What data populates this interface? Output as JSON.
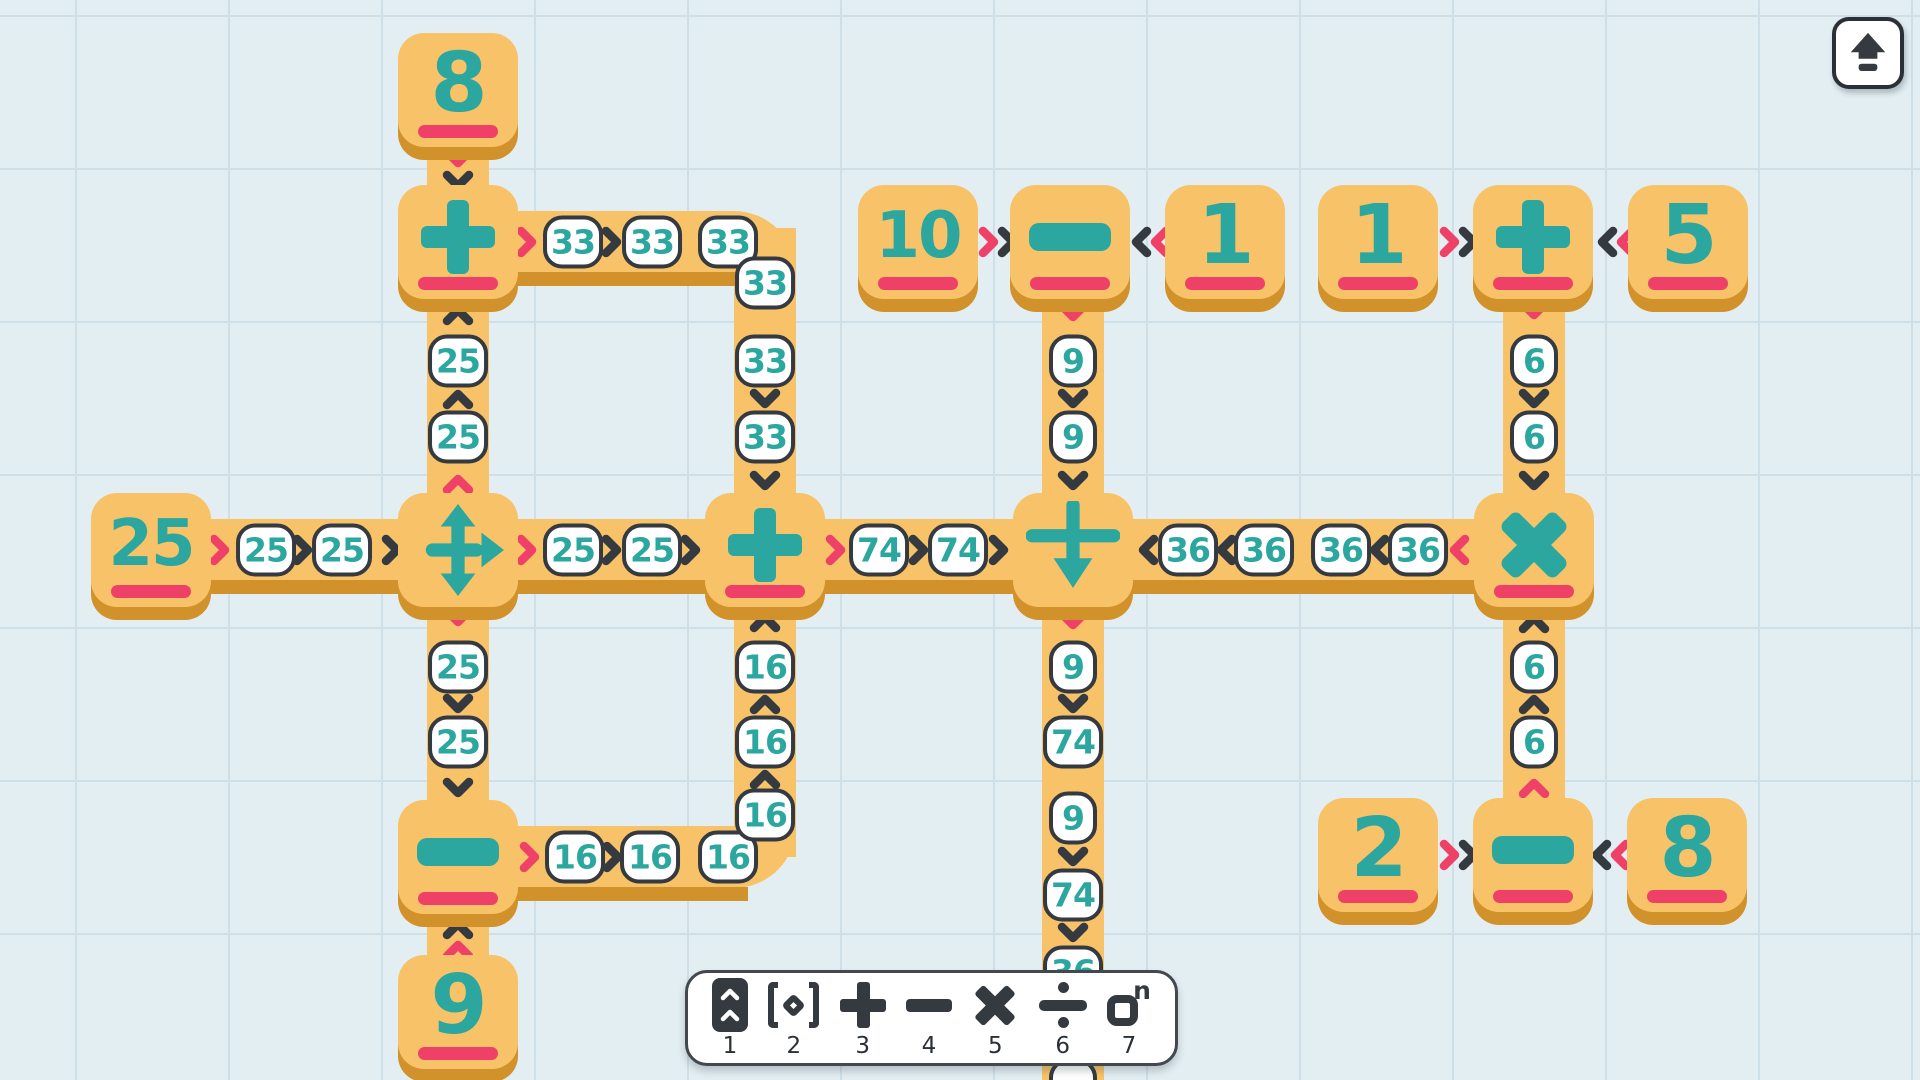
{
  "colors": {
    "background": "#e3eef2",
    "grid_line": "#cfdfe7",
    "tile_orange": "#f8c368",
    "tile_shadow_orange": "#d2922b",
    "teal": "#2ba7a0",
    "pink": "#ef4168",
    "dark": "#343a40",
    "bubble_bg": "#ffffff"
  },
  "board": {
    "paths": [
      {
        "x": 427,
        "y": 100,
        "w": 62,
        "h": 912
      },
      {
        "x": 734,
        "y": 228,
        "w": 62,
        "h": 322
      },
      {
        "x": 458,
        "y": 211,
        "w": 338,
        "h": 62,
        "br": "0 62px 0 0"
      },
      {
        "x": 734,
        "y": 550,
        "w": 62,
        "h": 307
      },
      {
        "x": 458,
        "y": 826,
        "w": 338,
        "h": 62,
        "br": "0 0 62px 0"
      },
      {
        "x": 151,
        "y": 519,
        "w": 1383,
        "h": 62
      },
      {
        "x": 1042,
        "y": 280,
        "w": 62,
        "h": 800
      },
      {
        "x": 1503,
        "y": 280,
        "w": 62,
        "h": 540
      },
      {
        "x": 151,
        "y": 580,
        "w": 1383,
        "h": 14,
        "sh": true
      },
      {
        "x": 482,
        "y": 272,
        "w": 266,
        "h": 14,
        "sh": true
      },
      {
        "x": 482,
        "y": 887,
        "w": 266,
        "h": 14,
        "sh": true
      }
    ],
    "tiles": [
      {
        "id": "tile-number-8-top",
        "kind": "number",
        "label": "8",
        "x": 458,
        "y": 90
      },
      {
        "id": "tile-operator-plus-left",
        "kind": "plus",
        "symbol": "+",
        "x": 458,
        "y": 242
      },
      {
        "id": "tile-number-25-source",
        "kind": "number",
        "label": "25",
        "x": 151,
        "y": 550
      },
      {
        "id": "tile-splitter",
        "kind": "splitter",
        "x": 458,
        "y": 550
      },
      {
        "id": "tile-operator-plus-center",
        "kind": "plus",
        "symbol": "+",
        "x": 765,
        "y": 550
      },
      {
        "id": "tile-junction-merge-down",
        "kind": "junction",
        "x": 1073,
        "y": 550
      },
      {
        "id": "tile-operator-times",
        "kind": "times",
        "symbol": "×",
        "x": 1534,
        "y": 550
      },
      {
        "id": "tile-operator-minus-bottomleft",
        "kind": "minus",
        "symbol": "−",
        "x": 458,
        "y": 857
      },
      {
        "id": "tile-number-9-bottom",
        "kind": "number",
        "label": "9",
        "x": 458,
        "y": 1012
      },
      {
        "id": "tile-number-10",
        "kind": "number",
        "label": "10",
        "x": 918,
        "y": 242
      },
      {
        "id": "tile-operator-minus-top",
        "kind": "minus",
        "symbol": "−",
        "x": 1070,
        "y": 242
      },
      {
        "id": "tile-number-1-left",
        "kind": "number",
        "label": "1",
        "x": 1225,
        "y": 242
      },
      {
        "id": "tile-number-1-right",
        "kind": "number",
        "label": "1",
        "x": 1378,
        "y": 242
      },
      {
        "id": "tile-operator-plus-right",
        "kind": "plus",
        "symbol": "+",
        "x": 1533,
        "y": 242
      },
      {
        "id": "tile-number-5",
        "kind": "number",
        "label": "5",
        "x": 1688,
        "y": 242
      },
      {
        "id": "tile-number-2",
        "kind": "number",
        "label": "2",
        "x": 1378,
        "y": 855
      },
      {
        "id": "tile-operator-minus-bottomright",
        "kind": "minus",
        "symbol": "−",
        "x": 1533,
        "y": 855
      },
      {
        "id": "tile-number-8-bottom",
        "kind": "number",
        "label": "8",
        "x": 1687,
        "y": 855
      }
    ],
    "bubbles": [
      {
        "v": "25",
        "x": 266,
        "y": 550
      },
      {
        "v": "25",
        "x": 342,
        "y": 550
      },
      {
        "v": "25",
        "x": 573,
        "y": 550
      },
      {
        "v": "25",
        "x": 652,
        "y": 550
      },
      {
        "v": "74",
        "x": 879,
        "y": 550
      },
      {
        "v": "74",
        "x": 958,
        "y": 550
      },
      {
        "v": "36",
        "x": 1188,
        "y": 550
      },
      {
        "v": "36",
        "x": 1264,
        "y": 550
      },
      {
        "v": "36",
        "x": 1341,
        "y": 550
      },
      {
        "v": "36",
        "x": 1418,
        "y": 550
      },
      {
        "v": "33",
        "x": 573,
        "y": 242
      },
      {
        "v": "33",
        "x": 652,
        "y": 242
      },
      {
        "v": "33",
        "x": 728,
        "y": 242
      },
      {
        "v": "33",
        "x": 765,
        "y": 283
      },
      {
        "v": "33",
        "x": 765,
        "y": 361
      },
      {
        "v": "33",
        "x": 765,
        "y": 437
      },
      {
        "v": "25",
        "x": 458,
        "y": 361
      },
      {
        "v": "25",
        "x": 458,
        "y": 437
      },
      {
        "v": "25",
        "x": 458,
        "y": 667
      },
      {
        "v": "25",
        "x": 458,
        "y": 742
      },
      {
        "v": "16",
        "x": 575,
        "y": 857
      },
      {
        "v": "16",
        "x": 650,
        "y": 857
      },
      {
        "v": "16",
        "x": 728,
        "y": 857
      },
      {
        "v": "16",
        "x": 765,
        "y": 815
      },
      {
        "v": "16",
        "x": 765,
        "y": 742
      },
      {
        "v": "16",
        "x": 765,
        "y": 667
      },
      {
        "v": "9",
        "x": 1073,
        "y": 361
      },
      {
        "v": "9",
        "x": 1073,
        "y": 437
      },
      {
        "v": "9",
        "x": 1073,
        "y": 667
      },
      {
        "v": "74",
        "x": 1073,
        "y": 742
      },
      {
        "v": "9",
        "x": 1073,
        "y": 818
      },
      {
        "v": "74",
        "x": 1073,
        "y": 895
      },
      {
        "v": "36",
        "x": 1073,
        "y": 972
      },
      {
        "v": "",
        "x": 1073,
        "y": 1085
      },
      {
        "v": "6",
        "x": 1534,
        "y": 361
      },
      {
        "v": "6",
        "x": 1534,
        "y": 437
      },
      {
        "v": "6",
        "x": 1534,
        "y": 667
      },
      {
        "v": "6",
        "x": 1534,
        "y": 742
      }
    ],
    "chevrons": [
      {
        "d": "d",
        "c": "pink",
        "x": 458,
        "y": 158
      },
      {
        "d": "d",
        "c": "dark",
        "x": 458,
        "y": 181
      },
      {
        "d": "u",
        "c": "dark",
        "x": 458,
        "y": 315
      },
      {
        "d": "u",
        "c": "dark",
        "x": 458,
        "y": 399
      },
      {
        "d": "u",
        "c": "pink",
        "x": 458,
        "y": 484
      },
      {
        "d": "d",
        "c": "pink",
        "x": 458,
        "y": 617
      },
      {
        "d": "d",
        "c": "dark",
        "x": 458,
        "y": 704
      },
      {
        "d": "d",
        "c": "dark",
        "x": 458,
        "y": 788
      },
      {
        "d": "u",
        "c": "dark",
        "x": 458,
        "y": 929
      },
      {
        "d": "u",
        "c": "pink",
        "x": 458,
        "y": 950
      },
      {
        "d": "r",
        "c": "pink",
        "x": 527,
        "y": 242
      },
      {
        "d": "r",
        "c": "dark",
        "x": 612,
        "y": 242
      },
      {
        "d": "d",
        "c": "dark",
        "x": 765,
        "y": 399
      },
      {
        "d": "d",
        "c": "dark",
        "x": 765,
        "y": 481
      },
      {
        "d": "r",
        "c": "pink",
        "x": 220,
        "y": 550
      },
      {
        "d": "r",
        "c": "dark",
        "x": 303,
        "y": 550
      },
      {
        "d": "r",
        "c": "dark",
        "x": 392,
        "y": 550
      },
      {
        "d": "r",
        "c": "pink",
        "x": 527,
        "y": 550
      },
      {
        "d": "r",
        "c": "dark",
        "x": 612,
        "y": 550
      },
      {
        "d": "r",
        "c": "dark",
        "x": 691,
        "y": 550
      },
      {
        "d": "r",
        "c": "pink",
        "x": 836,
        "y": 550
      },
      {
        "d": "r",
        "c": "dark",
        "x": 919,
        "y": 550
      },
      {
        "d": "r",
        "c": "dark",
        "x": 999,
        "y": 550
      },
      {
        "d": "l",
        "c": "dark",
        "x": 1148,
        "y": 550
      },
      {
        "d": "l",
        "c": "dark",
        "x": 1226,
        "y": 550
      },
      {
        "d": "l",
        "c": "dark",
        "x": 1379,
        "y": 550
      },
      {
        "d": "l",
        "c": "pink",
        "x": 1459,
        "y": 550
      },
      {
        "d": "r",
        "c": "pink",
        "x": 530,
        "y": 857
      },
      {
        "d": "r",
        "c": "dark",
        "x": 613,
        "y": 857
      },
      {
        "d": "u",
        "c": "dark",
        "x": 765,
        "y": 779
      },
      {
        "d": "u",
        "c": "dark",
        "x": 765,
        "y": 704
      },
      {
        "d": "u",
        "c": "dark",
        "x": 765,
        "y": 622
      },
      {
        "d": "r",
        "c": "pink",
        "x": 989,
        "y": 242
      },
      {
        "d": "r",
        "c": "dark",
        "x": 1008,
        "y": 242
      },
      {
        "d": "l",
        "c": "dark",
        "x": 1141,
        "y": 242
      },
      {
        "d": "l",
        "c": "pink",
        "x": 1160,
        "y": 242
      },
      {
        "d": "d",
        "c": "pink",
        "x": 1073,
        "y": 312
      },
      {
        "d": "d",
        "c": "dark",
        "x": 1073,
        "y": 399
      },
      {
        "d": "d",
        "c": "dark",
        "x": 1073,
        "y": 481
      },
      {
        "d": "d",
        "c": "pink",
        "x": 1073,
        "y": 620
      },
      {
        "d": "d",
        "c": "dark",
        "x": 1073,
        "y": 704
      },
      {
        "d": "d",
        "c": "dark",
        "x": 1073,
        "y": 857
      },
      {
        "d": "d",
        "c": "dark",
        "x": 1073,
        "y": 933
      },
      {
        "d": "r",
        "c": "pink",
        "x": 1450,
        "y": 242
      },
      {
        "d": "r",
        "c": "dark",
        "x": 1469,
        "y": 242
      },
      {
        "d": "l",
        "c": "dark",
        "x": 1607,
        "y": 242
      },
      {
        "d": "l",
        "c": "pink",
        "x": 1626,
        "y": 242
      },
      {
        "d": "d",
        "c": "pink",
        "x": 1534,
        "y": 310
      },
      {
        "d": "d",
        "c": "dark",
        "x": 1534,
        "y": 399
      },
      {
        "d": "d",
        "c": "dark",
        "x": 1534,
        "y": 481
      },
      {
        "d": "u",
        "c": "dark",
        "x": 1534,
        "y": 623
      },
      {
        "d": "u",
        "c": "dark",
        "x": 1534,
        "y": 704
      },
      {
        "d": "u",
        "c": "pink",
        "x": 1534,
        "y": 788
      },
      {
        "d": "r",
        "c": "pink",
        "x": 1450,
        "y": 855
      },
      {
        "d": "r",
        "c": "dark",
        "x": 1469,
        "y": 855
      },
      {
        "d": "l",
        "c": "dark",
        "x": 1601,
        "y": 855
      },
      {
        "d": "l",
        "c": "pink",
        "x": 1620,
        "y": 855
      }
    ]
  },
  "toolbar": {
    "items": [
      {
        "key": "1",
        "icon": "path-tool-icon"
      },
      {
        "key": "2",
        "icon": "anchor-brackets-icon"
      },
      {
        "key": "3",
        "icon": "add-icon"
      },
      {
        "key": "4",
        "icon": "subtract-icon"
      },
      {
        "key": "5",
        "icon": "multiply-icon"
      },
      {
        "key": "6",
        "icon": "divide-icon"
      },
      {
        "key": "7",
        "icon": "exponent-icon"
      }
    ]
  },
  "eject_button": {
    "icon": "eject-icon"
  }
}
